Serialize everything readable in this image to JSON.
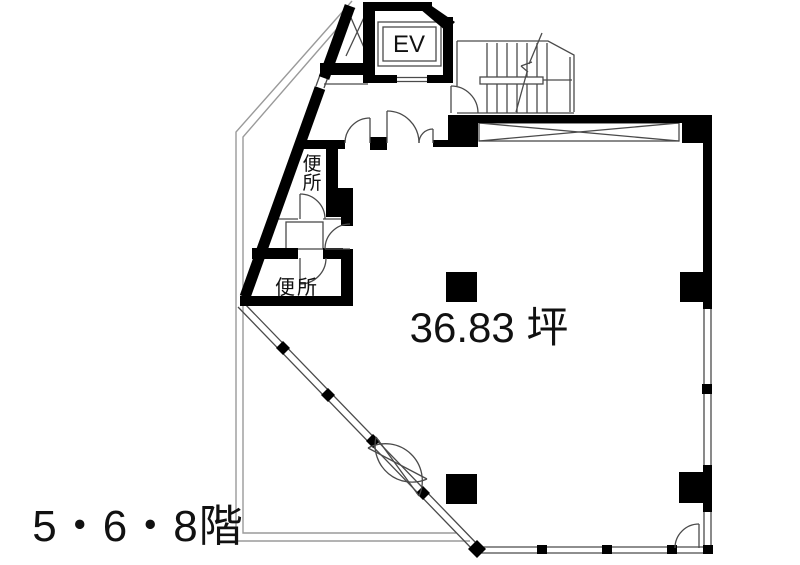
{
  "plan": {
    "floors_label": "5・6・8階",
    "area_label": "36.83 坪",
    "elevator_label": "EV",
    "toilets": [
      {
        "label": "便所",
        "orientation": "vertical",
        "chars": [
          "便",
          "所"
        ]
      },
      {
        "label": "便所",
        "orientation": "horizontal"
      }
    ]
  },
  "colors": {
    "background": "#ffffff",
    "wall": "#000000",
    "line": "#4a4a4a",
    "outline": "#9a9a9a",
    "text": "#111111"
  }
}
